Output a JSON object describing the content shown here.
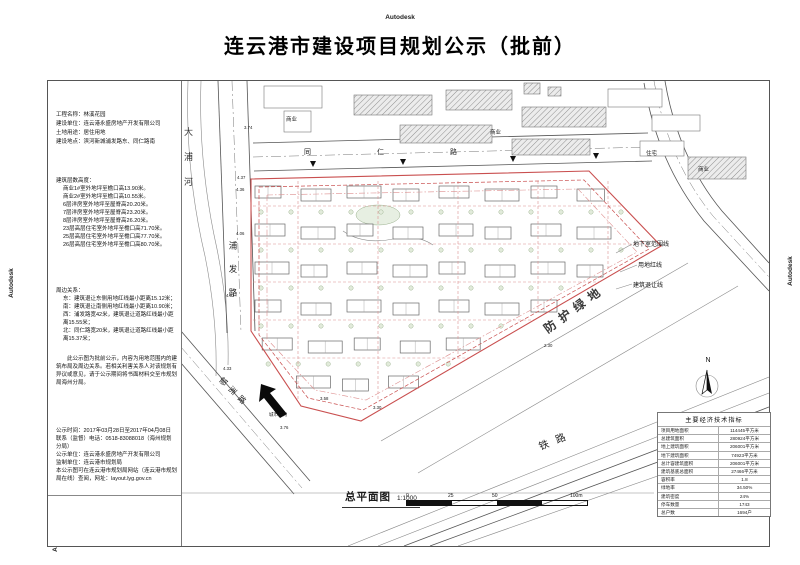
{
  "header": {
    "watermark": "Autodesk",
    "title": "连云港市建设项目规划公示（批前）"
  },
  "info_panel": {
    "project_lines": [
      "工程名称：林溪花园",
      "建设单位：连云港永盛房地产开发有限公司",
      "土地用途：居住用地",
      "建设地点：滨河新城浦发路东、同仁路南"
    ],
    "heights_title": "建筑层数高度：",
    "heights_lines": [
      "商业1#室外地坪至檐口高13.90米。",
      "商业2#室外地坪至檐口高10.55米。",
      "6层洋房室外地坪至屋脊高20.20米。",
      "7层洋房室外地坪至屋脊高23.20米。",
      "8层洋房室外地坪至屋脊高26.20米。",
      "23层高层住宅室外地坪至檐口高71.70米。",
      "25层高层住宅室外地坪至檐口高77.70米。",
      "26层高层住宅室外地坪至檐口高80.70米。"
    ],
    "relations_title": "周边关系：",
    "relations_lines": [
      "东：建筑退让东侧用地红线最小距离15.12米；",
      "南：建筑退让南侧用地红线最小距离10.90米；",
      "西：浦发路宽42米，建筑退让道路红线最小距离15.55米；",
      "北：同仁路宽20米，建筑退让道路红线最小距离15.37米；"
    ],
    "notice_paragraph": "此公示图为批前公示，内容为用地范围内的建筑布局及周边关系。若相关利害关系人对该规划有异议或意见，请于公示期间将书面材料交至市规划局海州分局。",
    "publicity_lines": [
      "公示时间：2017年03月28日至2017年04月08日",
      "联系（监督）电话：0518-83088018（海州规划分局）",
      "公示单位：连云港永盛房地产开发有限公司",
      "监制单位：连云港市规划局",
      "本公示图可在连云港市规划局网站（连云港市规划局在线）查阅，网址：layout.lyg.gov.cn"
    ]
  },
  "map": {
    "river": "大浦河",
    "road_west": "浦发路",
    "road_north": "同仁路",
    "road_southwest": "郁洲路",
    "railway": "铁路",
    "green_belt": "防护绿地",
    "legend": [
      "地下室范围线",
      "用地红线",
      "建筑退让线"
    ],
    "labels": {
      "commercial": "商业",
      "residential": "住宅"
    },
    "north": "N",
    "direction_label": "城市方向",
    "spot_elevations": [
      "3.74",
      "4.37",
      "4.36",
      "4.06",
      "4.32",
      "4.33",
      "3.58",
      "3.30",
      "2.30",
      "3.76"
    ],
    "colors": {
      "boundary_red": "#c94f4f",
      "setback_pink": "#dd8f8f",
      "line_black": "#444444"
    }
  },
  "footer": {
    "plan_label": "总平面图",
    "scale": "1:1000",
    "ticks": [
      "0",
      "25",
      "50",
      "100m"
    ]
  },
  "indicators_table": {
    "title": "主要经济技术指标",
    "rows": [
      [
        "项目用地面积",
        "114445平方米"
      ],
      [
        "总建筑面积",
        "280924平方米"
      ],
      [
        "地上建筑面积",
        "206001平方米"
      ],
      [
        "地下建筑面积",
        "74923平方米"
      ],
      [
        "总计容建筑面积",
        "206001平方米"
      ],
      [
        "建筑基底总面积",
        "27466平方米"
      ],
      [
        "容积率",
        "1.8"
      ],
      [
        "绿地率",
        "34.50%"
      ],
      [
        "建筑密度",
        "24%"
      ],
      [
        "停车数量",
        "1743"
      ],
      [
        "总户数",
        "1694户"
      ]
    ]
  }
}
